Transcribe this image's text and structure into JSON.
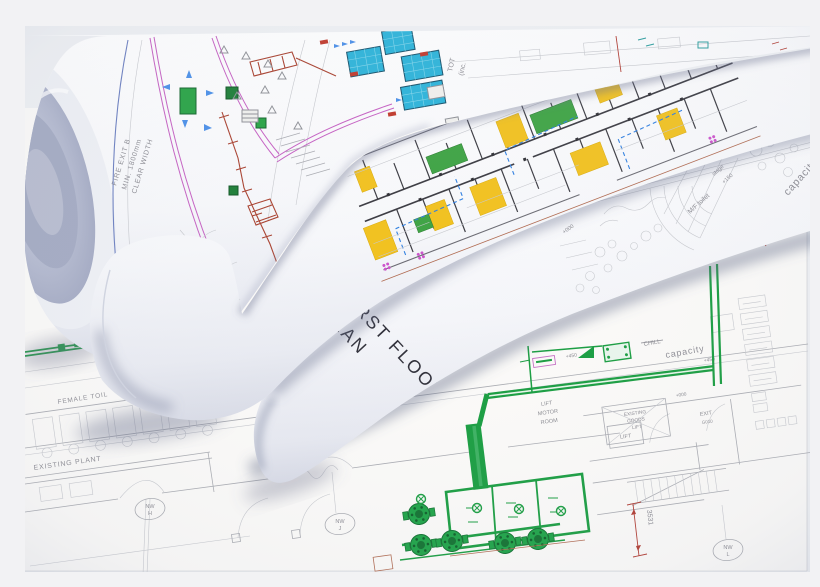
{
  "scene_colors": {
    "background_gray": "#f2f2f4",
    "paper_white": "#fbfbfc",
    "roll_core_blue_gray": "#a8aec5",
    "plan_line_gray": "#a9abb1",
    "cyan_panel": "#2cb3d9",
    "yellow_room": "#f1c11f",
    "green_room": "#3ea344",
    "pipe_green": "#169c3e",
    "magenta_line": "#c55fc2",
    "duct_red_brown": "#a8402e",
    "dimension_red": "#b03a30",
    "arrow_blue": "#4a8fe8",
    "edge_blue_line": "#6b7fc0"
  },
  "roll_top_left": {
    "fire_exit": [
      "FIRE EXIT B",
      "MIN. 1800mm",
      "CLEAR WIDTH"
    ],
    "total": [
      "TOT",
      "(inc."
    ]
  },
  "roll_front": {
    "title": [
      "FIRST FLOOR",
      "PLAN"
    ],
    "labels": {
      "mf_toilet": "M/F toilet",
      "stage": "stage",
      "stage_level": "+150",
      "capacity": "capacity",
      "level_000": "+000"
    }
  },
  "floor_plan": {
    "labels": {
      "existing_plant": "EXISTING PLANT",
      "female_toilet": "FEMALE TOIL",
      "lift_motor_room": [
        "LIFT",
        "MOTOR",
        "ROOM"
      ],
      "goods_lift": [
        "EXISTING",
        "GOODS",
        "LIFT"
      ],
      "exit": "EXIT",
      "exit_ref": "G010",
      "lift": "LIFT",
      "chill": "CHILL",
      "capacity": "capacity",
      "level_450": "+450",
      "level_450_b": "+450",
      "level_000": "+000",
      "dim": "3531",
      "grid_nw_h": [
        "NW",
        "H"
      ],
      "grid_nw_j": [
        "NW",
        "J"
      ],
      "grid_nw_l": [
        "NW",
        "L"
      ]
    }
  }
}
